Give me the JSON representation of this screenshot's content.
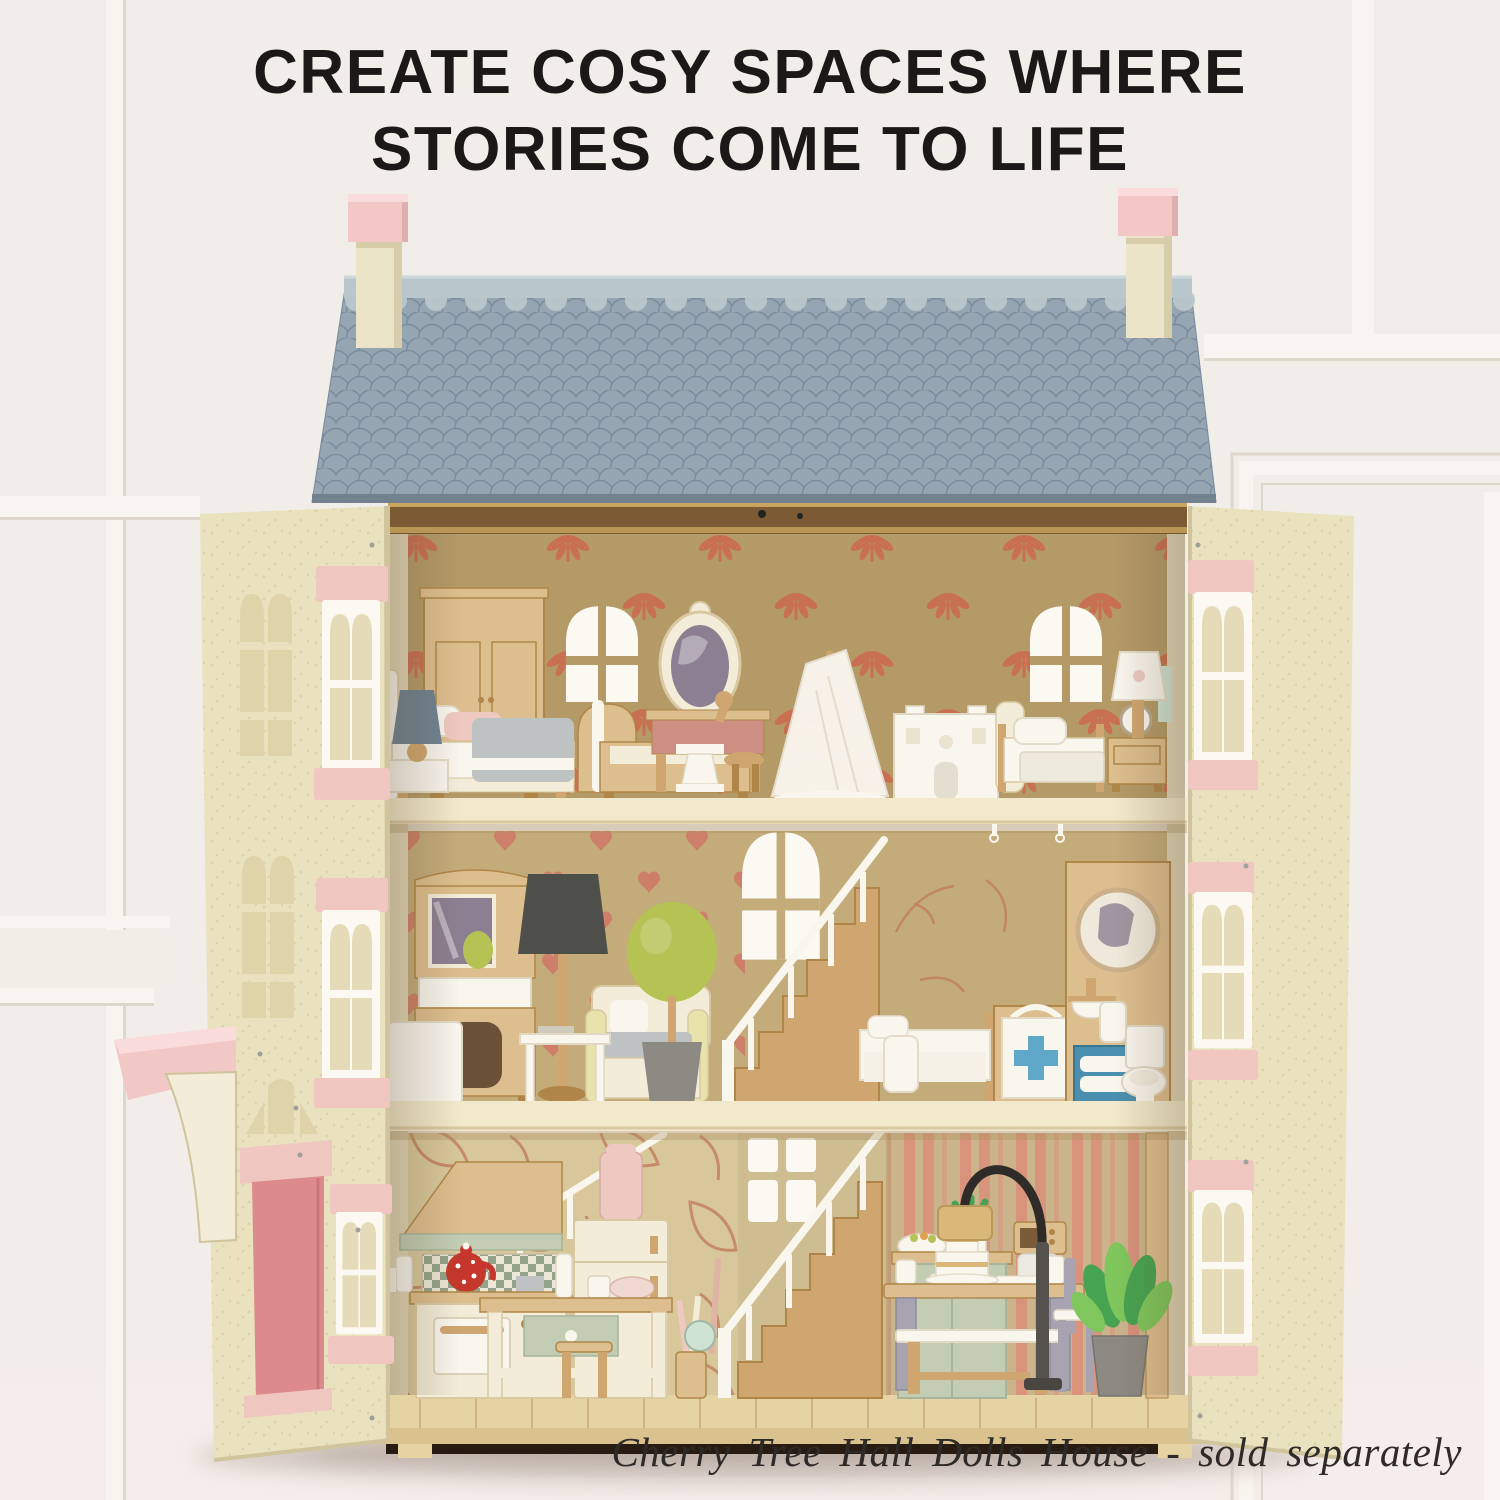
{
  "headline": {
    "line1": "CREATE COSY SPACES WHERE",
    "line2": "STORIES COME TO LIFE"
  },
  "caption": {
    "text": "Cherry Tree Hall Dolls House - sold separately"
  },
  "colors": {
    "backdrop": "#f1ede8",
    "floor_tint": "#f4edea",
    "panel_white": "#f8f4ef",
    "panel_shadow": "#ded7cc",
    "ink": "#1b1918",
    "caption_ink": "#2e2a28",
    "roof_main": "#8ea0ae",
    "roof_scallop": "#95a5b2",
    "roof_line": "#78899a",
    "roof_ridge": "#b9c7cc",
    "roof_edge": "#6e7e8b",
    "chim_pink": "#f2c7c5",
    "chim_pink_dk": "#dfafaf",
    "chim_cream": "#ece4c9",
    "chim_cream_dk": "#d8cdaa",
    "facade": "#eae2bf",
    "facade_cut": "#ded3a9",
    "facade_edge": "#cfc49c",
    "lintel": "#f0c6c0",
    "window_white": "#fcf9f2",
    "glass": "#e5dbb8",
    "door_pink": "#dd8a8c",
    "porch_pink": "#f2c8c6",
    "wall_top": "#b49a67",
    "wall_mid": "#c3ab7a",
    "wall_bot": "#d8c79b",
    "wall_stair": "#cfbd92",
    "motif": "#c96f52",
    "heart": "#ce7f6a",
    "leafline": "#c27c5b",
    "stripe": "#d9927c",
    "stripe_bg": "#cbb48b",
    "floor_cream": "#f2e8cc",
    "floor_edge": "#d9c9a2",
    "deck": "#e5d3a3",
    "deck_line": "#c9a878",
    "base_dark": "#281c12",
    "fascia": "#7b5a34",
    "fascia_gold": "#c9a55f",
    "side_wall": "#e0d6b6",
    "wood_l": "#ddbe8e",
    "wood_m": "#cfa66f",
    "wood_d": "#b08648",
    "cream_f": "#f3ecd8",
    "white_f": "#f9f6ee",
    "grey_blue": "#6f8292",
    "mirror_g": "#8d7f92",
    "sage": "#c2cdb4",
    "sage_line": "#a8b59a",
    "check_g": "#93a389",
    "check_bg": "#ece7d7",
    "red": "#c5372c",
    "topiary": "#b5c254",
    "plant": "#46a351",
    "plant_l": "#7fc75c",
    "pot": "#8d8a84",
    "blue": "#4b8fae",
    "blue_l": "#5fa8c9",
    "lavender": "#a7a3b0",
    "lamp_d": "#4e4e4a",
    "arc_d": "#2e2b28",
    "gold": "#d9b87a",
    "blanket": "#bfc2c2",
    "soft_pink": "#eec9c2",
    "rose": "#cd8f84",
    "mint": "#cfe3d4",
    "stroke_soft": "#e1d9c6",
    "shadow_soft": "#c9bcb2"
  }
}
